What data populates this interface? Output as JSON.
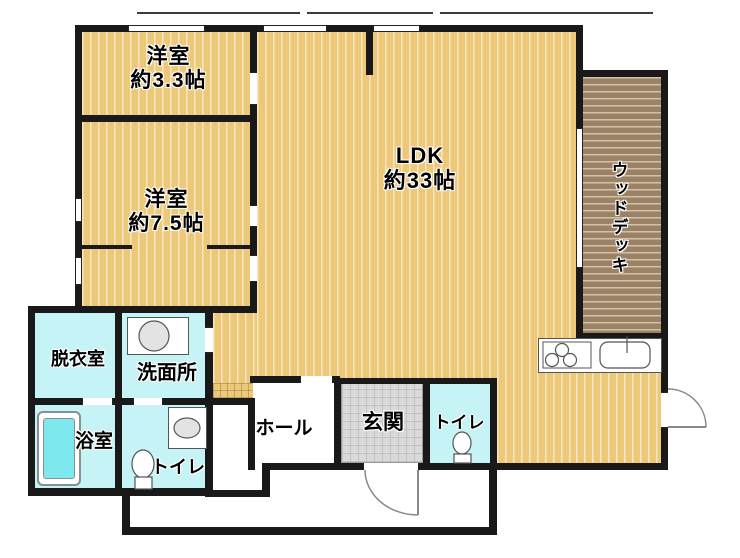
{
  "floorplan": {
    "rooms": {
      "bedroom_small": {
        "label": "洋室",
        "size": "約3.3帖"
      },
      "bedroom_large": {
        "label": "洋室",
        "size": "約7.5帖"
      },
      "ldk": {
        "label": "LDK",
        "size": "約33帖"
      },
      "wood_deck": {
        "label": "ウッドデッキ"
      },
      "dressing_room": {
        "label": "脱衣室"
      },
      "washroom": {
        "label": "洗面所"
      },
      "bathroom": {
        "label": "浴室"
      },
      "toilet_west": {
        "label": "トイレ"
      },
      "toilet_east": {
        "label": "トイレ"
      },
      "hall": {
        "label": "ホール"
      },
      "entrance": {
        "label": "玄関"
      }
    },
    "icons": {
      "stove": "stove-icon",
      "kitchen_sink": "kitchen-sink-icon",
      "washbasin": "washbasin-icon",
      "toilet": "toilet-icon",
      "bathtub": "bathtub-icon",
      "door_swing": "door-swing-icon",
      "window": "window-icon"
    },
    "colors": {
      "wall": "#191919",
      "floor": "#ecc878",
      "floor_stripe": "#f9efd2",
      "deck": "#9b8266",
      "deck_stripe": "#d9c7ab",
      "wet_room": "#c5f3f6",
      "bathtub": "#7de9ee",
      "entrance_tile": "#dadada",
      "door_arc": "#888888"
    }
  }
}
